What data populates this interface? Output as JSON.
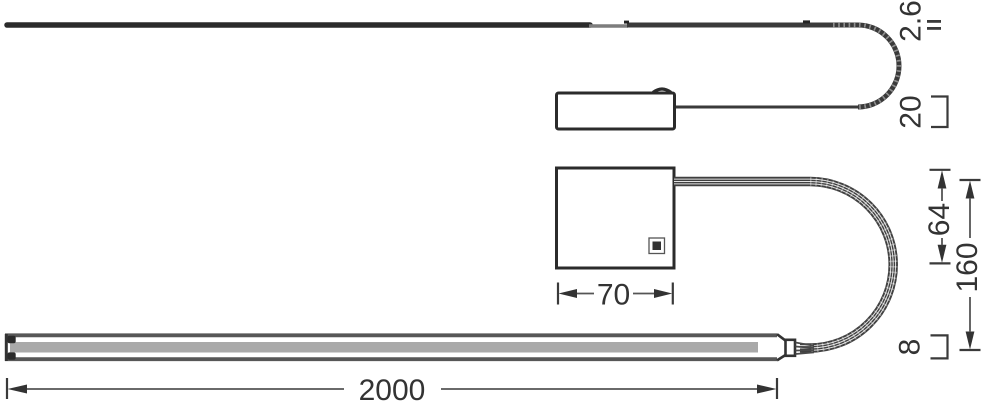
{
  "drawing": {
    "dimension_labels": {
      "cable_diameter": "2.6",
      "connector_height": "20",
      "driver_box_width": "70",
      "driver_box_height": "64",
      "loop_clearance": "160",
      "strip_length": "2000",
      "strip_height": "8"
    },
    "colors": {
      "line_dark": "#2b2b2b",
      "line_medium": "#3a3a3a",
      "dimension_line": "#555555",
      "strip_channel": "#a9a9a9",
      "background": "#ffffff"
    }
  }
}
